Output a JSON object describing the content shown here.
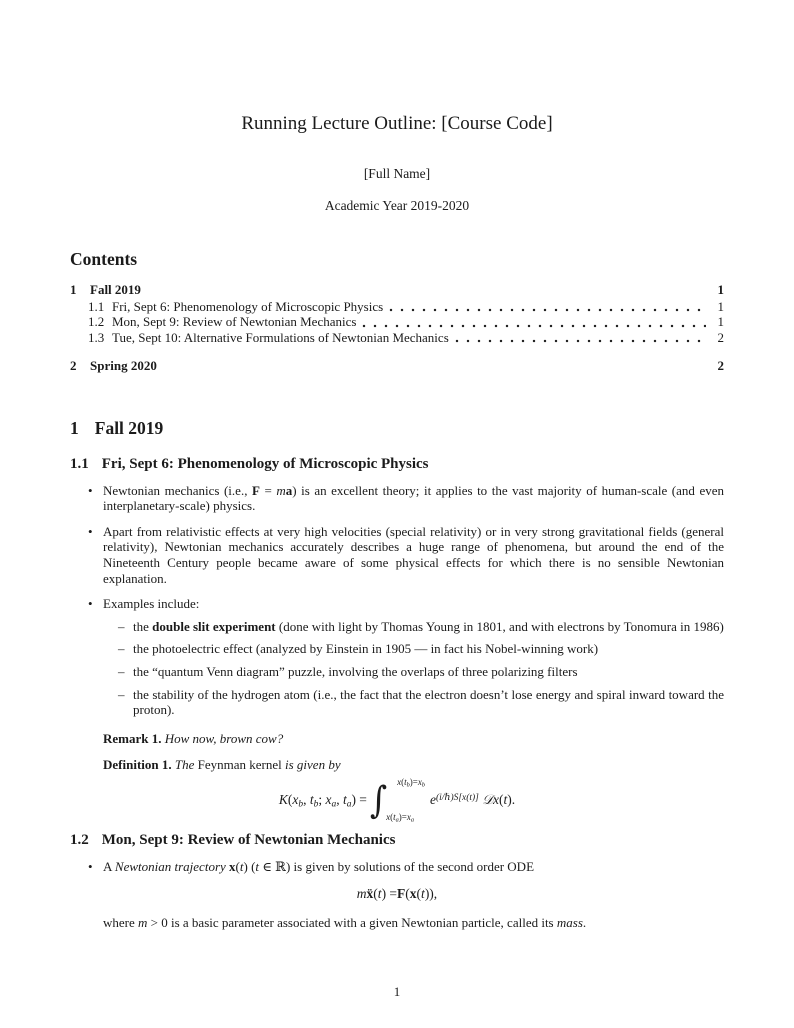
{
  "doc": {
    "title": "Running Lecture Outline: [Course Code]",
    "author": "[Full Name]",
    "date": "Academic Year 2019-2020",
    "page_number": "1",
    "text_color": "#1b1b1b",
    "background_color": "#ffffff"
  },
  "contents": {
    "heading": "Contents",
    "entries": [
      {
        "level": 1,
        "num": "1",
        "label": "Fall 2019",
        "page": "1"
      },
      {
        "level": 2,
        "num": "1.1",
        "label": "Fri, Sept 6: Phenomenology of Microscopic Physics",
        "page": "1"
      },
      {
        "level": 2,
        "num": "1.2",
        "label": "Mon, Sept 9: Review of Newtonian Mechanics",
        "page": "1"
      },
      {
        "level": 2,
        "num": "1.3",
        "label": "Tue, Sept 10: Alternative Formulations of Newtonian Mechanics",
        "page": "2"
      },
      {
        "level": 1,
        "num": "2",
        "label": "Spring 2020",
        "page": "2"
      }
    ]
  },
  "sections": {
    "s1": {
      "num": "1",
      "title": "Fall 2019"
    },
    "s1_1": {
      "num": "1.1",
      "title": "Fri, Sept 6: Phenomenology of Microscopic Physics"
    },
    "s1_2": {
      "num": "1.2",
      "title": "Mon, Sept 9: Review of Newtonian Mechanics"
    }
  },
  "body": {
    "bullet1": [
      {
        "t": "Newtonian mechanics (i.e., "
      },
      {
        "t": "F",
        "b": true
      },
      {
        "t": " = "
      },
      {
        "t": "m",
        "i": true
      },
      {
        "t": "a",
        "b": true
      },
      {
        "t": ") is an excellent theory; it applies to the vast majority of human-scale (and even interplanetary-scale) physics."
      }
    ],
    "bullet2": [
      {
        "t": "Apart from relativistic effects at very high velocities (special relativity) or in very strong gravitational fields (general relativity), Newtonian mechanics accurately describes a huge range of phenomena, but around the end of the Nineteenth Century people became aware of some physical effects for which there is no sensible Newtonian explanation."
      }
    ],
    "bullet3": [
      {
        "t": "Examples include:"
      }
    ],
    "sub_bullets": {
      "d1": [
        {
          "t": "the "
        },
        {
          "t": "double slit experiment",
          "b": true
        },
        {
          "t": " (done with light by Thomas Young in 1801, and with electrons by Tonomura in 1986)"
        }
      ],
      "d2": [
        {
          "t": "the photoelectric effect (analyzed by Einstein in 1905 — in fact his Nobel-winning work)"
        }
      ],
      "d3": [
        {
          "t": "the “quantum Venn diagram” puzzle, involving the overlaps of three polarizing filters"
        }
      ],
      "d4": [
        {
          "t": "the stability of the hydrogen atom (i.e., the fact that the electron doesn’t lose energy and spiral inward toward the proton)."
        }
      ]
    },
    "remark": [
      {
        "t": "Remark 1.",
        "b": true
      },
      {
        "t": " "
      },
      {
        "t": "How now, brown cow?",
        "i": true
      }
    ],
    "definition": [
      {
        "t": "Definition 1.",
        "b": true
      },
      {
        "t": " "
      },
      {
        "t": "The ",
        "i": true
      },
      {
        "t": "Feynman kernel"
      },
      {
        "t": " is given by",
        "i": true
      }
    ],
    "feynman_formula": {
      "lhs": [
        {
          "t": "K",
          "i": true
        },
        {
          "t": "("
        },
        {
          "t": "x",
          "i": true
        },
        {
          "t": "b",
          "i": true,
          "sub": true
        },
        {
          "t": ", "
        },
        {
          "t": "t",
          "i": true
        },
        {
          "t": "b",
          "i": true,
          "sub": true
        },
        {
          "t": "; "
        },
        {
          "t": "x",
          "i": true
        },
        {
          "t": "a",
          "i": true,
          "sub": true
        },
        {
          "t": ", "
        },
        {
          "t": "t",
          "i": true
        },
        {
          "t": "a",
          "i": true,
          "sub": true
        },
        {
          "t": ") = "
        }
      ],
      "integral_upper": [
        {
          "t": "x",
          "i": true
        },
        {
          "t": "("
        },
        {
          "t": "t",
          "i": true
        },
        {
          "t": "b",
          "i": true,
          "sub": true
        },
        {
          "t": ")="
        },
        {
          "t": "x",
          "i": true
        },
        {
          "t": "b",
          "i": true,
          "sub": true
        }
      ],
      "integral_lower": [
        {
          "t": "x",
          "i": true
        },
        {
          "t": "("
        },
        {
          "t": "t",
          "i": true
        },
        {
          "t": "a",
          "i": true,
          "sub": true
        },
        {
          "t": ")="
        },
        {
          "t": "x",
          "i": true
        },
        {
          "t": "a",
          "i": true,
          "sub": true
        }
      ],
      "rhs": [
        {
          "t": "e",
          "i": true
        },
        {
          "t": "(i/ℏ)S[x(t)]",
          "i": true,
          "sup": true
        },
        {
          "t": " 𝒟",
          "i": true
        },
        {
          "t": "x",
          "i": true
        },
        {
          "t": "("
        },
        {
          "t": "t",
          "i": true
        },
        {
          "t": ")."
        }
      ]
    },
    "bullet_1_2": [
      {
        "t": "A "
      },
      {
        "t": "Newtonian trajectory",
        "i": true
      },
      {
        "t": " "
      },
      {
        "t": "x",
        "b": true
      },
      {
        "t": "("
      },
      {
        "t": "t",
        "i": true
      },
      {
        "t": ") ("
      },
      {
        "t": "t",
        "i": true
      },
      {
        "t": " ∈ ℝ) is given by solutions of the second order ODE"
      }
    ],
    "newton_formula": [
      {
        "t": "m",
        "i": true
      },
      {
        "t": " "
      },
      {
        "t": "ẍ",
        "b": true
      },
      {
        "t": "("
      },
      {
        "t": "t",
        "i": true
      },
      {
        "t": ") = "
      },
      {
        "t": "F",
        "b": true
      },
      {
        "t": "("
      },
      {
        "t": "x",
        "b": true
      },
      {
        "t": "("
      },
      {
        "t": "t",
        "i": true
      },
      {
        "t": ")),"
      }
    ],
    "where_line": [
      {
        "t": "where "
      },
      {
        "t": "m",
        "i": true
      },
      {
        "t": " > 0 is a basic parameter associated with a given Newtonian particle, called its "
      },
      {
        "t": "mass",
        "i": true
      },
      {
        "t": "."
      }
    ]
  }
}
